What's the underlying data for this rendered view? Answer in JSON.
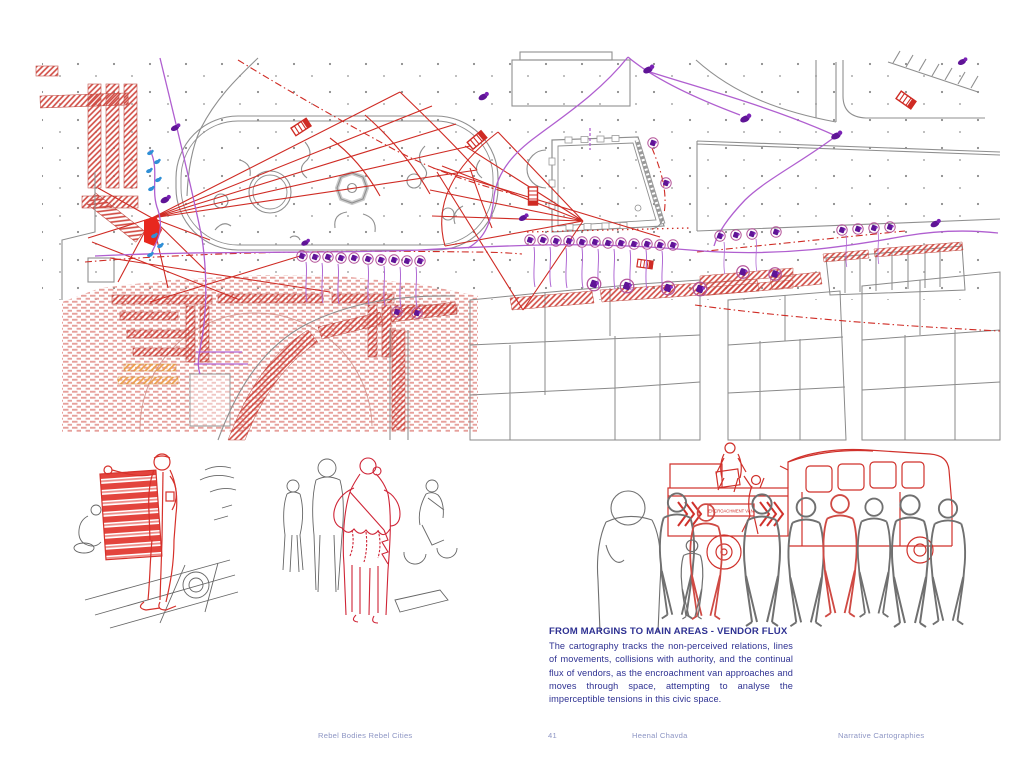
{
  "page": {
    "background": "#ffffff"
  },
  "map": {
    "colors": {
      "line_gray": "#8f8f8f",
      "plan_red": "#cf2b24",
      "hatch_red": "#e2908a",
      "hatch_orange": "#eda04e",
      "flow_purple": "#b05fd0",
      "vendor_purple": "#5f1496",
      "figure_blue": "#2f8fd6"
    }
  },
  "illustrations": {
    "van_label": "ENCROACHMENT VAN"
  },
  "caption": {
    "heading": "FROM MARGINS TO MAIN AREAS - VENDOR FLUX",
    "body": "The cartography tracks the non-perceived relations, lines of movements, collisions with authority, and the continual flux of vendors, as the encroachment van approaches and moves through space, attempting to analyse the imperceptible tensions in this civic space.",
    "text_color": "#2e3192"
  },
  "footer": {
    "book": "Rebel Bodies Rebel Cities",
    "page_number": "41",
    "author": "Heenal Chavda",
    "section": "Narrative Cartographies",
    "text_color": "#8e96c4"
  }
}
